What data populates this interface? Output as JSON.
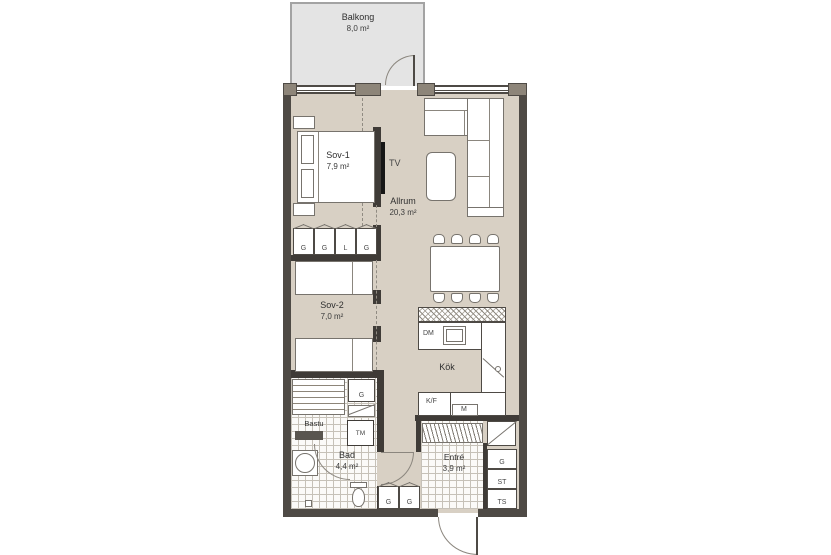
{
  "balcony": {
    "name": "Balkong",
    "area": "8,0 m²"
  },
  "rooms": {
    "sov1": {
      "name": "Sov-1",
      "area": "7,9 m²"
    },
    "sov2": {
      "name": "Sov-2",
      "area": "7,0 m²"
    },
    "allrum": {
      "name": "Allrum",
      "area": "20,3 m²"
    },
    "kok": {
      "name": "Kök"
    },
    "bastu": {
      "name": "Bastu"
    },
    "bad": {
      "name": "Bad",
      "area": "4,4 m²"
    },
    "entre": {
      "name": "Entré",
      "area": "3,9 m²"
    }
  },
  "appliances": {
    "tv": "TV",
    "dm": "DM",
    "kf": "K/F",
    "m": "M",
    "tm": "TM"
  },
  "closets": {
    "sov_row": [
      "G",
      "G",
      "L",
      "G"
    ],
    "hall": [
      "G",
      "G"
    ],
    "bath": "G",
    "entre": [
      "G",
      "ST",
      "TS"
    ]
  },
  "colors": {
    "floor": "#d8d0c4",
    "wall": "#4e4a45",
    "pier": "#8d8579",
    "balcony": "#e4e4e4",
    "furniture_stroke": "#77736d",
    "tile_line": "#c6c1b8",
    "text": "#2f2f2f"
  }
}
